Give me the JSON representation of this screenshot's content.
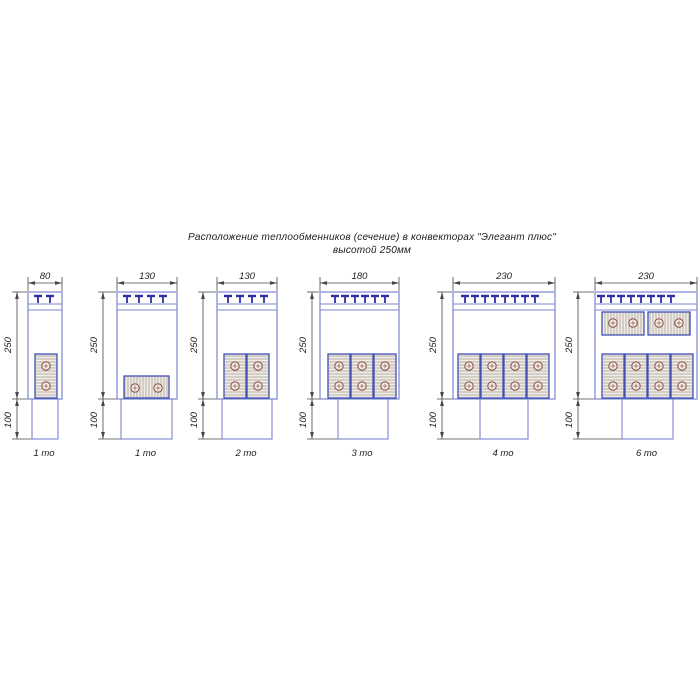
{
  "title": {
    "line1": "Расположение теплообменников (сечение) в конвекторах \"Элегант плюс\"",
    "line2": "высотой 250мм"
  },
  "colors": {
    "outline_blue": "#7b86cf",
    "block_border_blue": "#4150b4",
    "grille_clip_navy": "#2b2fa2",
    "hatch_line": "#b2a89c",
    "block_fill": "#efece7",
    "pipe_circle": "#8c5547",
    "pipe_fill": "#f3f0ea",
    "dimension": "#474747",
    "text": "#1c1c1c",
    "background": "#ffffff"
  },
  "layout": {
    "dim_line_y": 283,
    "dim_ext_top": 277,
    "width_label_y": 279,
    "box_top": 292,
    "tbar_y": 296,
    "tstem_y2": 303,
    "grille_line1_y": 304,
    "grille_line2_y": 310,
    "box_bottom": 399,
    "duct_bottom": 439,
    "caption_y": 456,
    "height_label_cy": 345,
    "base_label_cy": 420
  },
  "drawings": [
    {
      "caption": "1 то",
      "width_label": "80",
      "height_label": "250",
      "base_label": "100",
      "box": [
        28,
        62
      ],
      "duct": [
        32,
        58
      ],
      "dim_x": 17,
      "tmarks": [
        38,
        50
      ],
      "blocks": [
        {
          "hatch": "h",
          "x": 35,
          "y": 354,
          "w": 22,
          "h": 44
        }
      ],
      "circles": [
        [
          46,
          366
        ],
        [
          46,
          386
        ]
      ]
    },
    {
      "caption": "1 то",
      "width_label": "130",
      "height_label": "250",
      "base_label": "100",
      "box": [
        117,
        177
      ],
      "duct": [
        121,
        172
      ],
      "dim_x": 103,
      "tmarks": [
        127,
        139,
        151,
        163
      ],
      "blocks": [
        {
          "hatch": "v",
          "x": 124,
          "y": 376,
          "w": 45,
          "h": 22
        }
      ],
      "circles": [
        [
          135,
          388
        ],
        [
          158,
          388
        ]
      ]
    },
    {
      "caption": "2 то",
      "width_label": "130",
      "height_label": "250",
      "base_label": "100",
      "box": [
        217,
        277
      ],
      "duct": [
        222,
        272
      ],
      "dim_x": 203,
      "tmarks": [
        228,
        240,
        252,
        264
      ],
      "blocks": [
        {
          "hatch": "h",
          "x": 224,
          "y": 354,
          "w": 22,
          "h": 44
        },
        {
          "hatch": "h",
          "x": 247,
          "y": 354,
          "w": 22,
          "h": 44
        }
      ],
      "circles": [
        [
          235,
          366
        ],
        [
          235,
          386
        ],
        [
          258,
          366
        ],
        [
          258,
          386
        ]
      ]
    },
    {
      "caption": "3 то",
      "width_label": "180",
      "height_label": "250",
      "base_label": "100",
      "box": [
        320,
        399
      ],
      "duct": [
        338,
        388
      ],
      "dim_x": 312,
      "tmarks": [
        335,
        345,
        355,
        365,
        375,
        385
      ],
      "blocks": [
        {
          "hatch": "h",
          "x": 328,
          "y": 354,
          "w": 22,
          "h": 44
        },
        {
          "hatch": "h",
          "x": 351,
          "y": 354,
          "w": 22,
          "h": 44
        },
        {
          "hatch": "h",
          "x": 374,
          "y": 354,
          "w": 22,
          "h": 44
        }
      ],
      "circles": [
        [
          339,
          366
        ],
        [
          339,
          386
        ],
        [
          362,
          366
        ],
        [
          362,
          386
        ],
        [
          385,
          366
        ],
        [
          385,
          386
        ]
      ]
    },
    {
      "caption": "4 то",
      "width_label": "230",
      "height_label": "250",
      "base_label": "100",
      "box": [
        453,
        555
      ],
      "duct": [
        480,
        528
      ],
      "dim_x": 442,
      "tmarks": [
        465,
        475,
        485,
        495,
        505,
        515,
        525,
        535
      ],
      "blocks": [
        {
          "hatch": "h",
          "x": 458,
          "y": 354,
          "w": 22,
          "h": 44
        },
        {
          "hatch": "h",
          "x": 481,
          "y": 354,
          "w": 22,
          "h": 44
        },
        {
          "hatch": "h",
          "x": 504,
          "y": 354,
          "w": 22,
          "h": 44
        },
        {
          "hatch": "h",
          "x": 527,
          "y": 354,
          "w": 22,
          "h": 44
        }
      ],
      "circles": [
        [
          469,
          366
        ],
        [
          469,
          386
        ],
        [
          492,
          366
        ],
        [
          492,
          386
        ],
        [
          515,
          366
        ],
        [
          515,
          386
        ],
        [
          538,
          366
        ],
        [
          538,
          386
        ]
      ]
    },
    {
      "caption": "6 то",
      "width_label": "230",
      "height_label": "250",
      "base_label": "100",
      "box": [
        595,
        697
      ],
      "duct": [
        622,
        673
      ],
      "dim_x": 578,
      "tmarks": [
        601,
        611,
        621,
        631,
        641,
        651,
        661,
        671
      ],
      "blocks": [
        {
          "hatch": "v",
          "x": 602,
          "y": 312,
          "w": 42,
          "h": 23
        },
        {
          "hatch": "v",
          "x": 648,
          "y": 312,
          "w": 42,
          "h": 23
        },
        {
          "hatch": "h",
          "x": 602,
          "y": 354,
          "w": 22,
          "h": 44
        },
        {
          "hatch": "h",
          "x": 625,
          "y": 354,
          "w": 22,
          "h": 44
        },
        {
          "hatch": "h",
          "x": 648,
          "y": 354,
          "w": 22,
          "h": 44
        },
        {
          "hatch": "h",
          "x": 671,
          "y": 354,
          "w": 22,
          "h": 44
        }
      ],
      "circles": [
        [
          613,
          323
        ],
        [
          633,
          323
        ],
        [
          659,
          323
        ],
        [
          679,
          323
        ],
        [
          613,
          366
        ],
        [
          613,
          386
        ],
        [
          636,
          366
        ],
        [
          636,
          386
        ],
        [
          659,
          366
        ],
        [
          659,
          386
        ],
        [
          682,
          366
        ],
        [
          682,
          386
        ]
      ]
    }
  ]
}
